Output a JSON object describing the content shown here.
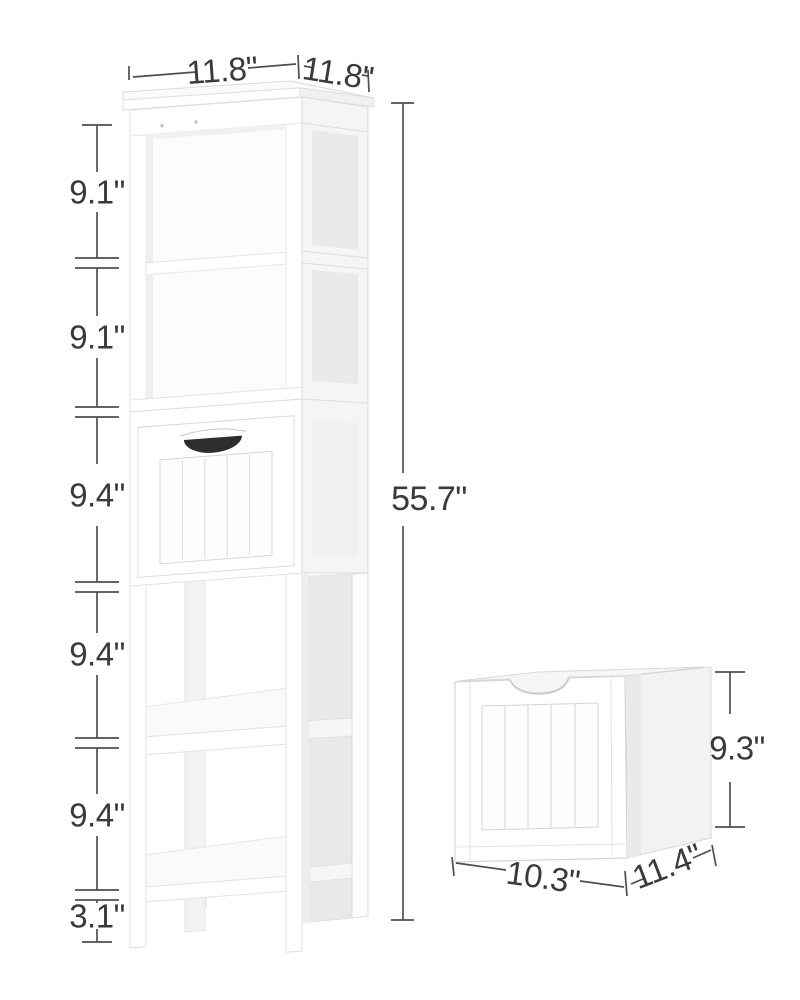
{
  "image_kind": "furniture dimension diagram",
  "colors": {
    "background": "#ffffff",
    "dimension_line": "#4f4f4f",
    "dimension_text": "#3a3a3a",
    "furniture_white": "#ffffff",
    "furniture_shadow": "#e9e9e9",
    "handle_dark": "#2d2d2d"
  },
  "tower": {
    "top_width_label": "11.8\"",
    "top_depth_label": "11.8\"",
    "height_label": "55.7\"",
    "section_labels": [
      "9.1\"",
      "9.1\"",
      "9.4\"",
      "9.4\"",
      "9.4\"",
      "3.1\""
    ]
  },
  "drawer_box": {
    "width_label": "10.3\"",
    "depth_label": "11.4\"",
    "height_label": "9.3\""
  }
}
